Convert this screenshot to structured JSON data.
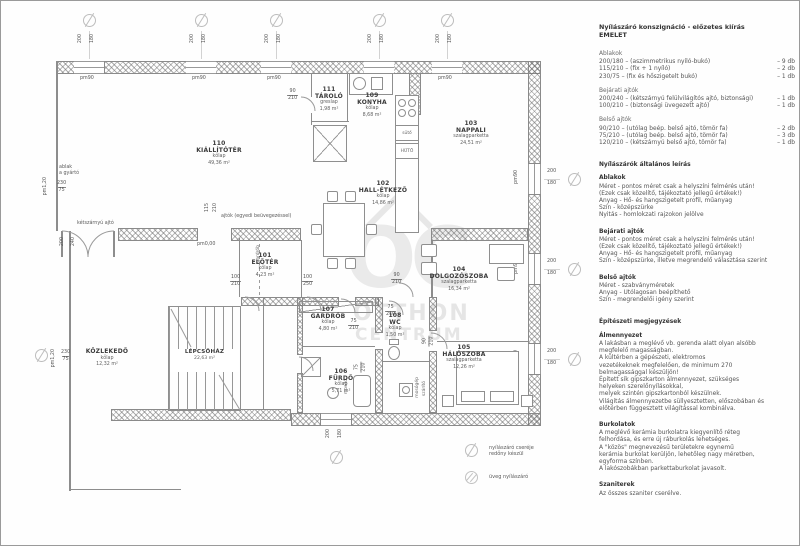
{
  "plan": {
    "rooms": [
      {
        "num": "110",
        "name": "KIÁLLÍTÓTÉR",
        "floor": "kőlap",
        "area": "49,36 m²"
      },
      {
        "num": "111",
        "name": "TÁROLÓ",
        "floor": "greslap",
        "area": "1,98 m²"
      },
      {
        "num": "109",
        "name": "KONYHA",
        "floor": "kőlap",
        "area": "8,68 m²"
      },
      {
        "num": "103",
        "name": "NAPPALI",
        "floor": "szalagparketta",
        "area": "24,51 m²"
      },
      {
        "num": "102",
        "name": "HALL-ÉTKEZŐ",
        "floor": "kőlap",
        "area": "14,86 m²"
      },
      {
        "num": "101",
        "name": "ELŐTÉR",
        "floor": "kőlap",
        "area": "4,23 m²"
      },
      {
        "num": "104",
        "name": "DOLGOZÓSZOBA",
        "floor": "szalagparketta",
        "area": "16,34 m²"
      },
      {
        "num": "107",
        "name": "GARDRÓB",
        "floor": "kőlap",
        "area": "4,80 m²"
      },
      {
        "num": "108",
        "name": "WC",
        "floor": "kőlap",
        "area": "1,50 m²"
      },
      {
        "num": "106",
        "name": "FÜRDŐ",
        "floor": "kőlap",
        "area": "5,71 m²"
      },
      {
        "num": "105",
        "name": "HÁLÓSZOBA",
        "floor": "szalagparketta",
        "area": "12,26 m²"
      },
      {
        "num": "",
        "name": "KÖZLEKEDŐ",
        "floor": "kőlap",
        "area": "12,32 m²"
      },
      {
        "num": "",
        "name": "LÉPCSŐHÁZ",
        "floor": "",
        "area": "22,63 m²"
      }
    ],
    "dims": {
      "d200": "200",
      "d180": "180",
      "d230": "230",
      "d75": "75",
      "d115": "115",
      "d210": "210",
      "d100": "100",
      "d250": "250",
      "d90": "90",
      "d240": "240",
      "pm90": "pm90",
      "pm120": "pm1,20",
      "pm000": "pm0,00"
    },
    "labels": {
      "ketszarnyu_ajto": "kétszárnyú ajtó",
      "ablak_gyarto": "ablak\na gyártó",
      "ajtok_egyedi": "ajtók (egyedi beüvegezéssel)",
      "gardrob_kis": "gardrób",
      "mosdo": "mosdó",
      "mosogep": "mosógép",
      "szarito": "szárító",
      "suto": "sütő",
      "huto": "HŰTŐ"
    },
    "legend": {
      "item1": "nyílászáró cseréje\nredőny készül",
      "item2": "üveg nyílászáró"
    },
    "watermark": {
      "mono": "OC",
      "word1": "OTTHON",
      "word2": "CENTRUM"
    }
  },
  "sidebar": {
    "title": "Nyílászáró konszignáció - előzetes kiírás",
    "subtitle": "EMELET",
    "schedule": [
      {
        "header": "Ablakok",
        "items": [
          {
            "spec": "200/180 – (aszimmetrikus nyíló-bukó)",
            "count": "– 9 db"
          },
          {
            "spec": "115/210 – (fix + 1 nyíló)",
            "count": "– 2 db"
          },
          {
            "spec": "230/75 – (fix és hőszigetelt bukó)",
            "count": "– 1 db"
          }
        ]
      },
      {
        "header": "Bejárati ajtók",
        "items": [
          {
            "spec": "200/240 – (kétszárnyú felülvilágítós ajtó, biztonsági)",
            "count": "– 1 db"
          },
          {
            "spec": "100/210 – (biztonsági üvegezett ajtó)",
            "count": "– 1 db"
          }
        ]
      },
      {
        "header": "Belső ajtók",
        "items": [
          {
            "spec": "90/210 – (utólag beép. belső ajtó, tömör fa)",
            "count": "– 2 db"
          },
          {
            "spec": "75/210 – (utólag beép. belső ajtó, tömör fa)",
            "count": "– 3 db"
          },
          {
            "spec": "120/210 – (kétszárnyú belső ajtó, tömör fa)",
            "count": "– 1 db"
          }
        ]
      }
    ],
    "general": {
      "title": "Nyílászárók általános leírás",
      "sections": [
        {
          "header": "Ablakok",
          "body": "Méret - pontos méret csak a helyszíni felmérés után!\n(Ezek csak közelítő, tájékoztató jellegű értékek!)\nAnyag - Hő- és hangszigetelt profil, műanyag\nSzín - középszürke\nNyitás - homlokzati rajzokon jelölve"
        },
        {
          "header": "Bejárati ajtók",
          "body": "Méret - pontos méret csak a helyszíni felmérés után!\n(Ezek csak közelítő, tájékoztató jellegű értékek!)\nAnyag - Hő- és hangszigetelt profil, műanyag\nSzín - középszürke, illetve megrendelő választása szerint"
        },
        {
          "header": "Belső ajtók",
          "body": "Méret - szabványméretek\nAnyag - Utólagosan beépíthető\nSzín - megrendelői igény szerint"
        }
      ]
    },
    "notes": {
      "title": "Építészeti megjegyzések",
      "sections": [
        {
          "header": "Álmennyezet",
          "body": "A lakásban a meglévő vb. gerenda alatt olyan alsóbb\nmegfelelő magasságban.\nA kültérben a gépészeti, elektromos\nvezetékeknek megfelelően, de minimum 270\nbelmagassággal készüljön!\nÉpített sík gipszkarton álmennyezet, szükséges\nhelyeken szerelőnyílásokkal,\nmelyek szintén gipszkartonból készülnek.\nVilágítás álmennyezetbe süllyesztetten, előszobában és\nelőtérben függesztett világítással kombinálva."
        },
        {
          "header": "Burkolatok",
          "body": "A meglévő kerámia burkolatra kiegyenlítő réteg\nfelhordása, és erre új ráburkolás lehetséges.\nA \"közös\" megnevezésű területekre egynemű\nkerámia burkolat kerüljön, lehetőleg nagy méretben,\negyforma színben.\nA lakószobákban parkettaburkolat javasolt."
        },
        {
          "header": "Szaniterek",
          "body": "Az összes szaniter cserélve."
        }
      ]
    }
  }
}
